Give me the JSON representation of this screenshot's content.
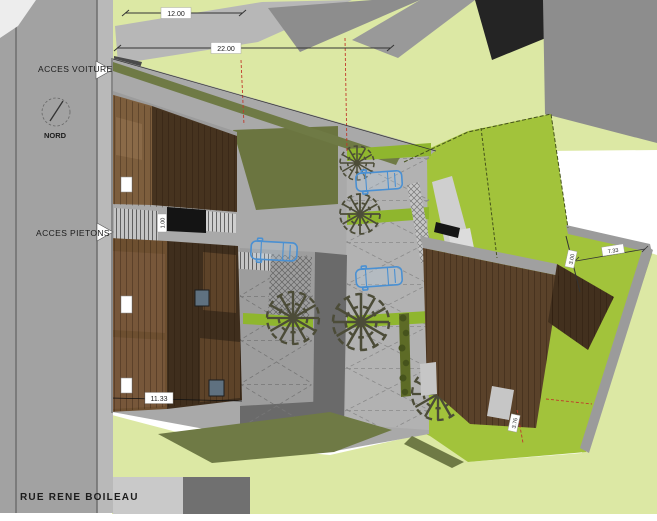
{
  "labels": {
    "access_car": "ACCES VOITURE",
    "access_pedestrian": "ACCES PIETONS",
    "north": "NORD",
    "street": "RUE RENE BOILEAU"
  },
  "dimensions": {
    "front_setback": "12.00",
    "plot_front": "22.00",
    "building_width": "11.33",
    "garden_width": "7.33",
    "path_width": "1.00",
    "fence_setback": "3.00",
    "garden_setback": "3.76"
  },
  "colors": {
    "road_gray": "#a2a2a2",
    "parking_gray": "#a9a9a9",
    "divider_gray": "#6a6a6a",
    "pale_green": "#dce8a4",
    "bright_green": "#a2c33b",
    "strip_green": "#8fb62e",
    "olive": "#6f7a45",
    "roof_light_brown": "#7d5e3d",
    "roof_dark_brown": "#46331f",
    "right_roof_brown": "#5a422a",
    "car_blue": "#4a90d2",
    "boundary_red": "#c0392b"
  }
}
